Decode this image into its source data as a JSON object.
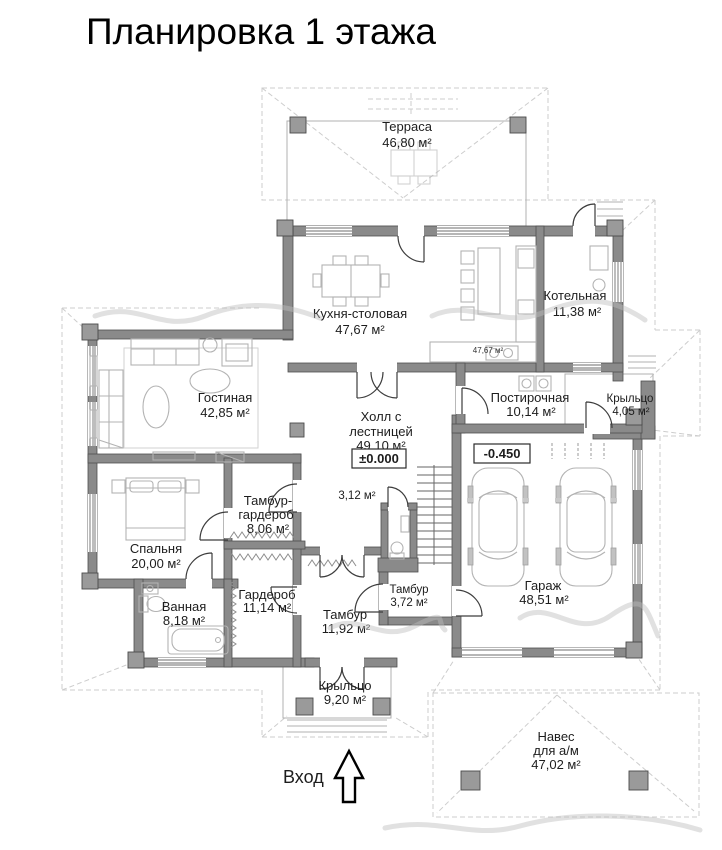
{
  "page": {
    "title": "Планировка 1 этажа"
  },
  "plan": {
    "rooms": {
      "terrace": {
        "name": "Терраса",
        "area": "46,80 м²"
      },
      "kitchen": {
        "name": "Кухня-столовая",
        "area": "47,67 м²"
      },
      "kitchen_note": {
        "area": "47,67 м²"
      },
      "boiler": {
        "name": "Котельная",
        "area": "11,38 м²"
      },
      "living": {
        "name": "Гостиная",
        "area": "42,85 м²"
      },
      "hall": {
        "name1": "Холл с",
        "name2": "лестницей",
        "area": "49,10 м²"
      },
      "wc": {
        "area": "3,12 м²"
      },
      "laundry": {
        "name": "Постирочная",
        "area": "10,14 м²"
      },
      "porch_right": {
        "name": "Крыльцо",
        "area": "4,05 м²"
      },
      "tambour_wardrobe": {
        "name1": "Тамбур-",
        "name2": "гардероб",
        "area": "8,06 м²"
      },
      "bedroom": {
        "name": "Спальня",
        "area": "20,00 м²"
      },
      "bathroom": {
        "name": "Ванная",
        "area": "8,18 м²"
      },
      "wardrobe": {
        "name": "Гардероб",
        "area": "11,14 м²"
      },
      "tambour_main": {
        "name": "Тамбур",
        "area": "11,92 м²"
      },
      "tambour_small": {
        "name": "Тамбур",
        "area": "3,72 м²"
      },
      "garage": {
        "name": "Гараж",
        "area": "48,51 м²"
      },
      "porch_front": {
        "name": "Крыльцо",
        "area": "9,20 м²"
      },
      "carport": {
        "name1": "Навес",
        "name2": "для а/м",
        "area": "47,02 м²"
      }
    },
    "levels": {
      "ground": "±0.000",
      "garage": "-0.450"
    },
    "entrance": {
      "label": "Вход"
    },
    "colors": {
      "wall": "#8a8a8a",
      "roof_dash": "#cdcdcd",
      "text": "#1d1d1d"
    }
  }
}
